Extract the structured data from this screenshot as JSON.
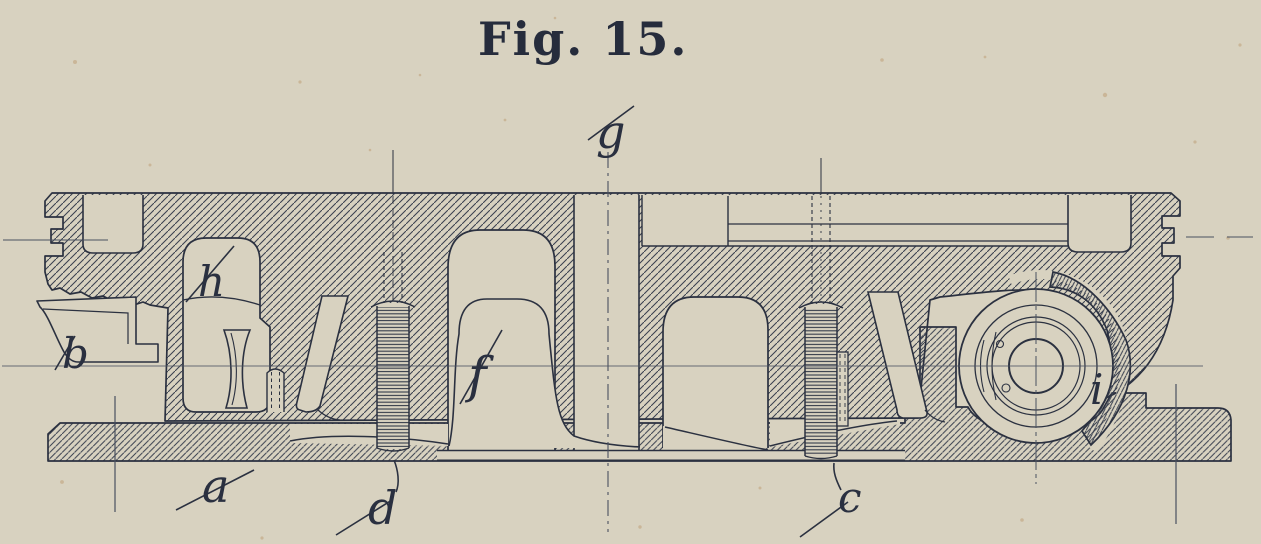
{
  "figure": {
    "title": "Fig. 15.",
    "type": "sectional engineering drawing, cross-section of a machine slide with gib strips, screws and a roller bearing",
    "part_labels": [
      "g",
      "h",
      "b",
      "f",
      "a",
      "d",
      "c",
      "i"
    ],
    "colors": {
      "paper": "#d8d2c0",
      "ink": "#2b3140",
      "hatch": "#3a4150",
      "centerline": "#4a5160"
    }
  }
}
